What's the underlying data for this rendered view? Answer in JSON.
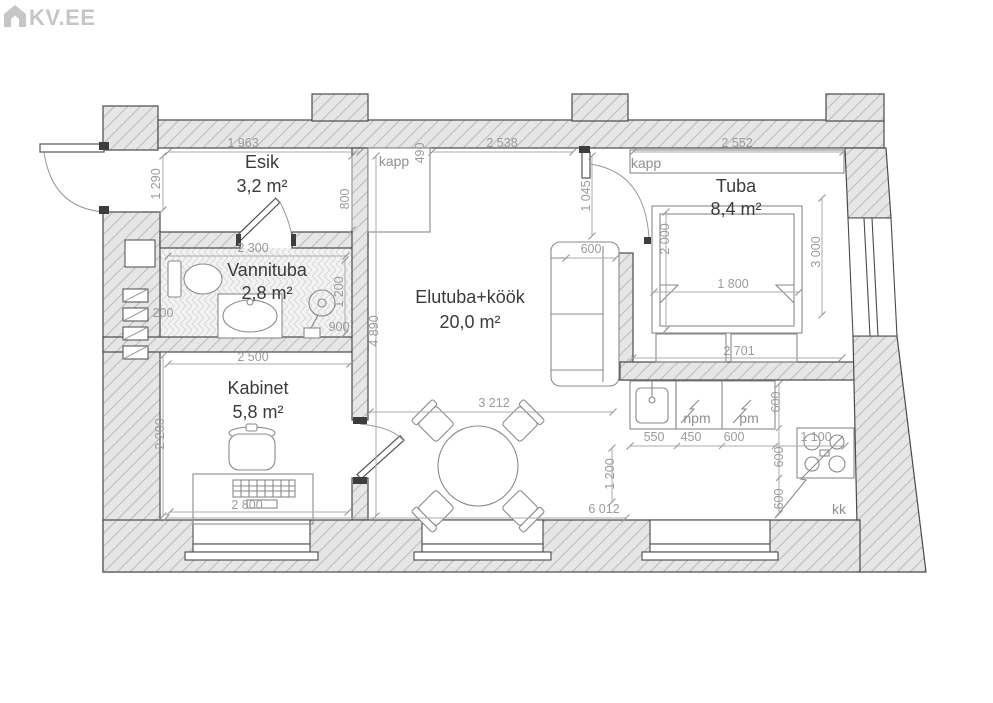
{
  "logo": {
    "text": "KV.EE"
  },
  "plan": {
    "rooms": [
      {
        "name": "Esik",
        "area": "3,2 m²",
        "x": 262,
        "y": 168,
        "ax": 262,
        "ay": 192
      },
      {
        "name": "Vannituba",
        "area": "2,8 m²",
        "x": 267,
        "y": 276,
        "ax": 267,
        "ay": 299
      },
      {
        "name": "Kabinet",
        "area": "5,8 m²",
        "x": 258,
        "y": 394,
        "ax": 258,
        "ay": 418
      },
      {
        "name": "Elutuba+köök",
        "area": "20,0 m²",
        "x": 470,
        "y": 303,
        "ax": 470,
        "ay": 328
      },
      {
        "name": "Tuba",
        "area": "8,4 m²",
        "x": 736,
        "y": 192,
        "ax": 736,
        "ay": 215
      }
    ],
    "fixture_labels": [
      {
        "text": "kapp",
        "x": 394,
        "y": 166
      },
      {
        "text": "kapp",
        "x": 646,
        "y": 168
      },
      {
        "text": "npm",
        "x": 697,
        "y": 423
      },
      {
        "text": "pm",
        "x": 749,
        "y": 423
      },
      {
        "text": "kk",
        "x": 839,
        "y": 514
      }
    ],
    "dimensions": [
      {
        "text": "1 963",
        "x": 243,
        "y": 147,
        "rot": 0
      },
      {
        "text": "490",
        "x": 424,
        "y": 153,
        "rot": -90
      },
      {
        "text": "2 538",
        "x": 502,
        "y": 147,
        "rot": 0
      },
      {
        "text": "2 552",
        "x": 737,
        "y": 147,
        "rot": 0
      },
      {
        "text": "1 290",
        "x": 160,
        "y": 184,
        "rot": -90
      },
      {
        "text": "800",
        "x": 349,
        "y": 199,
        "rot": -90
      },
      {
        "text": "1 045",
        "x": 590,
        "y": 196,
        "rot": -90
      },
      {
        "text": "600",
        "x": 591,
        "y": 253,
        "rot": 0
      },
      {
        "text": "2 300",
        "x": 253,
        "y": 252,
        "rot": 0
      },
      {
        "text": "1 200",
        "x": 343,
        "y": 292,
        "rot": -90
      },
      {
        "text": "200",
        "x": 163,
        "y": 317,
        "rot": 0
      },
      {
        "text": "900",
        "x": 339,
        "y": 331,
        "rot": 0
      },
      {
        "text": "2 000",
        "x": 669,
        "y": 239,
        "rot": -90
      },
      {
        "text": "1 800",
        "x": 733,
        "y": 288,
        "rot": 0
      },
      {
        "text": "3 000",
        "x": 820,
        "y": 252,
        "rot": -90
      },
      {
        "text": "2 701",
        "x": 739,
        "y": 355,
        "rot": 0
      },
      {
        "text": "2 500",
        "x": 253,
        "y": 361,
        "rot": 0
      },
      {
        "text": "2 200",
        "x": 164,
        "y": 434,
        "rot": -90
      },
      {
        "text": "4 890",
        "x": 378,
        "y": 331,
        "rot": -90
      },
      {
        "text": "2 800",
        "x": 247,
        "y": 509,
        "rot": 0
      },
      {
        "text": "3 212",
        "x": 494,
        "y": 407,
        "rot": 0
      },
      {
        "text": "550",
        "x": 654,
        "y": 441,
        "rot": 0
      },
      {
        "text": "450",
        "x": 691,
        "y": 441,
        "rot": 0
      },
      {
        "text": "600",
        "x": 734,
        "y": 441,
        "rot": 0
      },
      {
        "text": "1 100",
        "x": 816,
        "y": 441,
        "rot": 0
      },
      {
        "text": "600",
        "x": 780,
        "y": 402,
        "rot": -90
      },
      {
        "text": "600",
        "x": 783,
        "y": 457,
        "rot": -90
      },
      {
        "text": "600",
        "x": 783,
        "y": 499,
        "rot": -90
      },
      {
        "text": "1 200",
        "x": 614,
        "y": 474,
        "rot": -90
      },
      {
        "text": "6 012",
        "x": 604,
        "y": 513,
        "rot": 0
      }
    ]
  }
}
